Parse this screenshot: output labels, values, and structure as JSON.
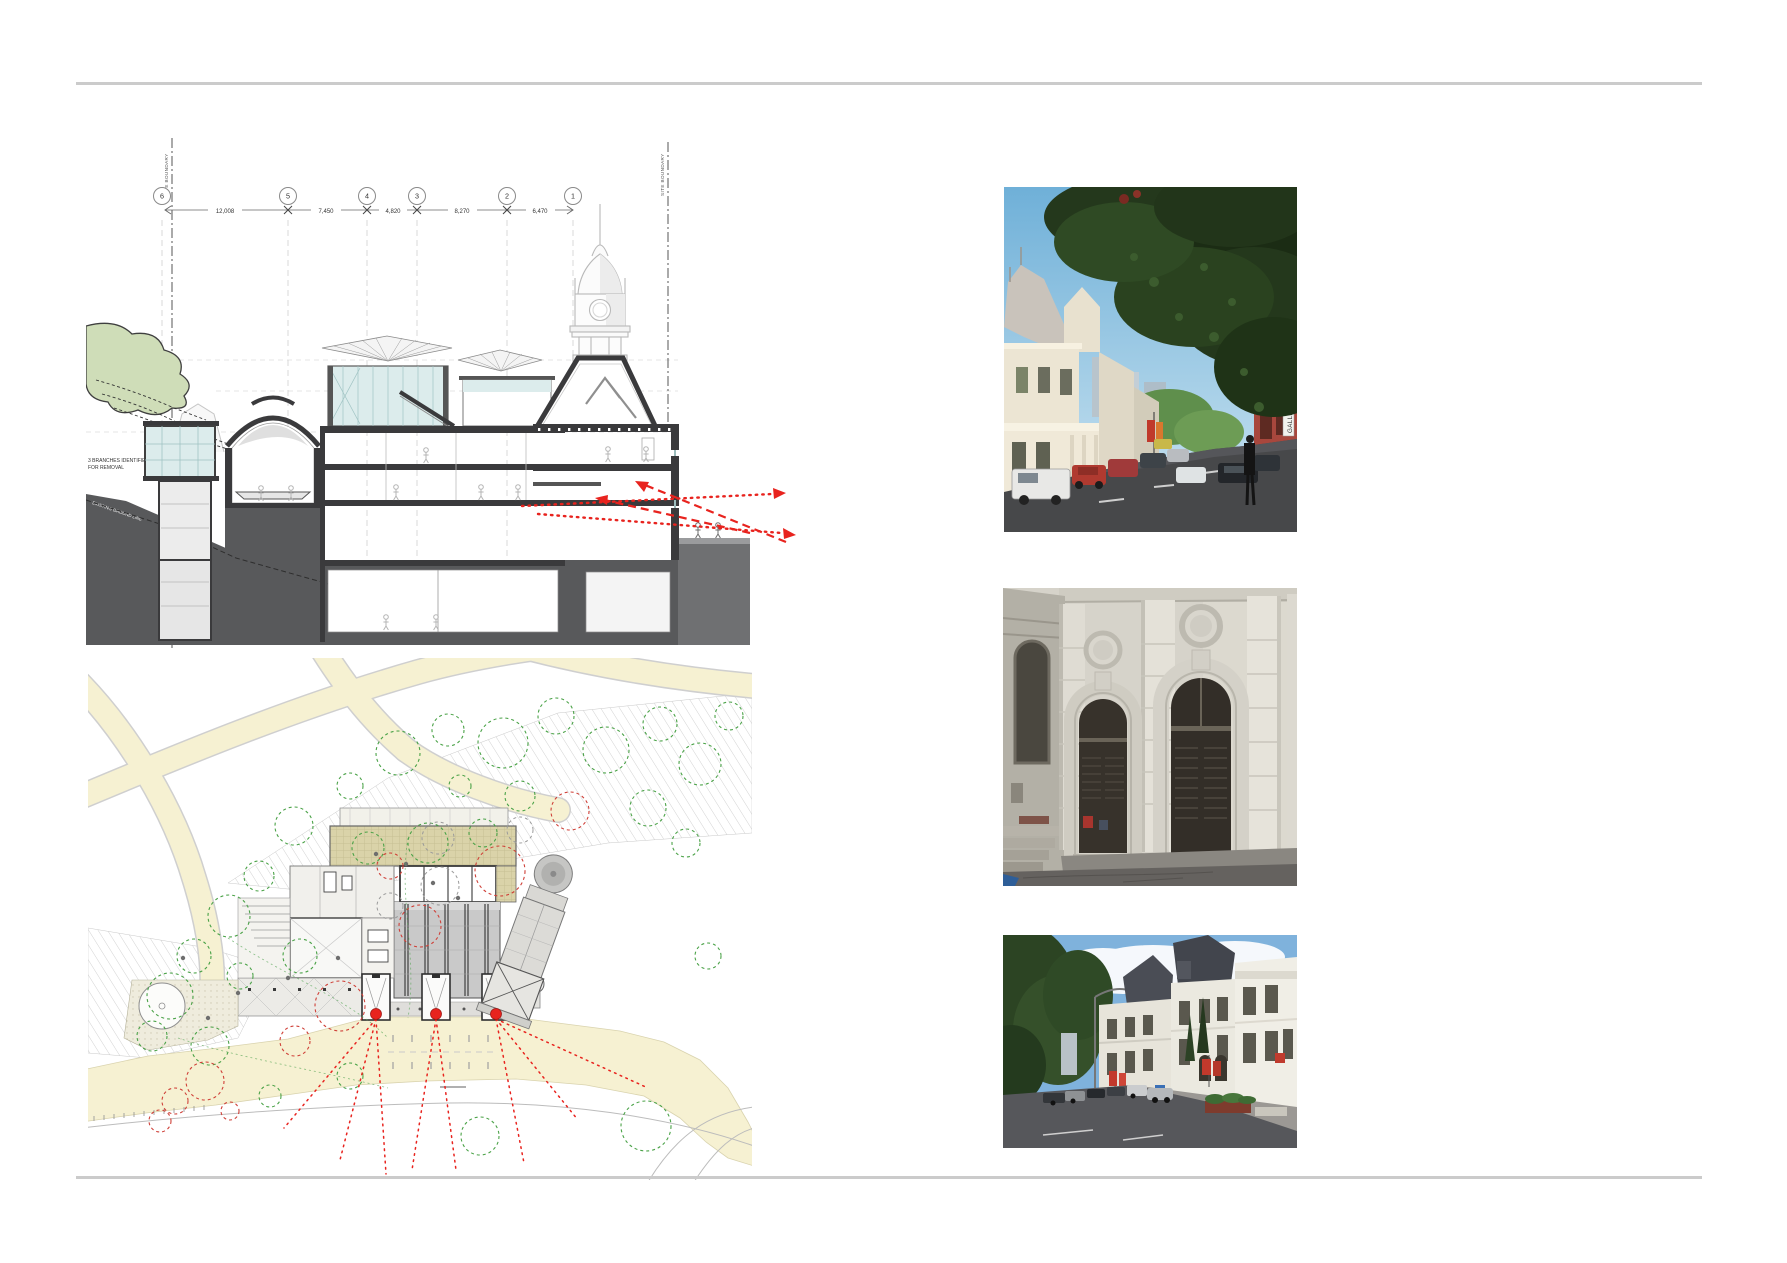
{
  "page": {
    "type": "architectural design report page"
  },
  "colors": {
    "rule": "#cbcbcb",
    "accent_red": "#e8231e",
    "section_ground": "#58595b",
    "section_wall": "#3a3a3c",
    "glass": "#dcecec",
    "path_cream": "#f6f1d2",
    "tree_green": "#4aa247",
    "tree_red": "#cf4038"
  },
  "section": {
    "grid_bubbles": [
      "6",
      "5",
      "4",
      "3",
      "2",
      "1"
    ],
    "dimensions": [
      "12,008",
      "7,450",
      "4,820",
      "8,270",
      "6,470"
    ],
    "boundary_label": "SITE BOUNDARY",
    "branches_note_1": "3 BRANCHES IDENTIFIED",
    "branches_note_2": "FOR REMOVAL",
    "ground_line_label": "EXISTING GROUND LINE"
  },
  "site_plan": {
    "description": "Roof and site plan of gallery in park: cream paths, hatched lawns, green and red tree survey circles, three entry bays marked with red dots and red dotted sight lines fanning to the street"
  },
  "photos": [
    {
      "alt": "Street view beneath a large overhanging tree canopy with white Victorian gallery buildings and parked cars",
      "sign_text": "GALLERY"
    },
    {
      "alt": "Heritage facade detail with two tall arched doorways, dark louvred doors and oculus medallions"
    },
    {
      "alt": "Heritage gallery building with slate mansard roofs seen along the street with parked cars and red banners"
    }
  ]
}
